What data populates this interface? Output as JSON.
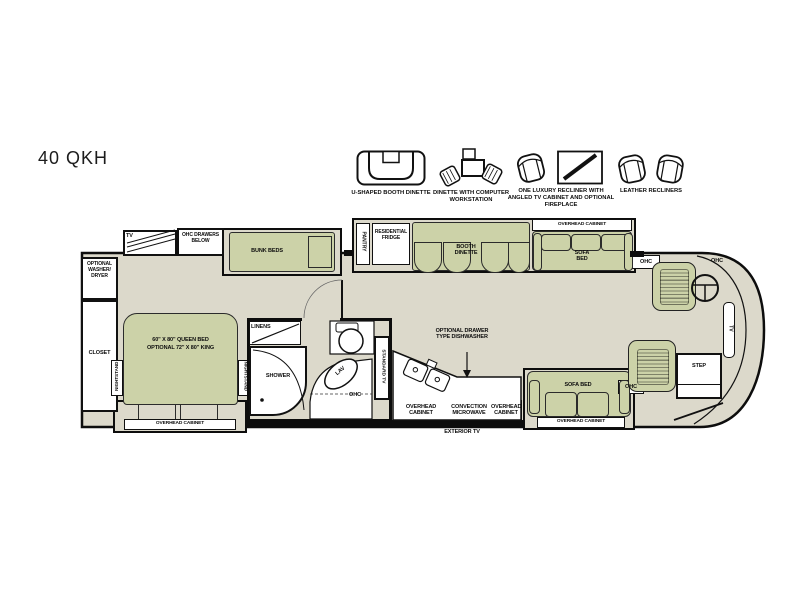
{
  "title": "40 QKH",
  "legend": {
    "items": [
      {
        "label": "U-SHAPED BOOTH DINETTE"
      },
      {
        "label": "DINETTE WITH COMPUTER WORKSTATION"
      },
      {
        "label": "ONE LUXURY RECLINER WITH ANGLED TV CABINET AND OPTIONAL FIREPLACE"
      },
      {
        "label": "LEATHER RECLINERS"
      }
    ]
  },
  "plan": {
    "colors": {
      "floor": "#dcd9cb",
      "furniture_green": "#ccd2a8",
      "wall": "#0d0d0d",
      "white": "#ffffff"
    },
    "labels": {
      "tv_rear": "TV",
      "ohc_drawers_below": "OHC DRAWERS BELOW",
      "optional_washer_dryer": "OPTIONAL WASHER/ DRYER",
      "closet": "CLOSET",
      "bunk_beds": "BUNK BEDS",
      "bed_line1": "60\" X 80\" QUEEN BED",
      "bed_line2": "OPTIONAL 72\" X 80\" KING",
      "nightstand": "NIGHTSTAND",
      "overhead_cabinet": "OVERHEAD CABINET",
      "linens": "LINENS",
      "shower": "SHOWER",
      "lav": "LAV",
      "ohc": "OHC",
      "pantry": "PANTRY",
      "residential_fridge": "RESIDENTIAL FRIDGE",
      "booth_dinette": "BOOTH DINETTE",
      "sofa_bed": "SOFA BED",
      "standard_tv": "STANDARD TV",
      "optional_dishwasher": "OPTIONAL DRAWER TYPE DISHWASHER",
      "convection_microwave": "CONVECTION MICROWAVE",
      "exterior_tv": "EXTERIOR TV",
      "step": "STEP",
      "tv_dash": "TV"
    }
  }
}
